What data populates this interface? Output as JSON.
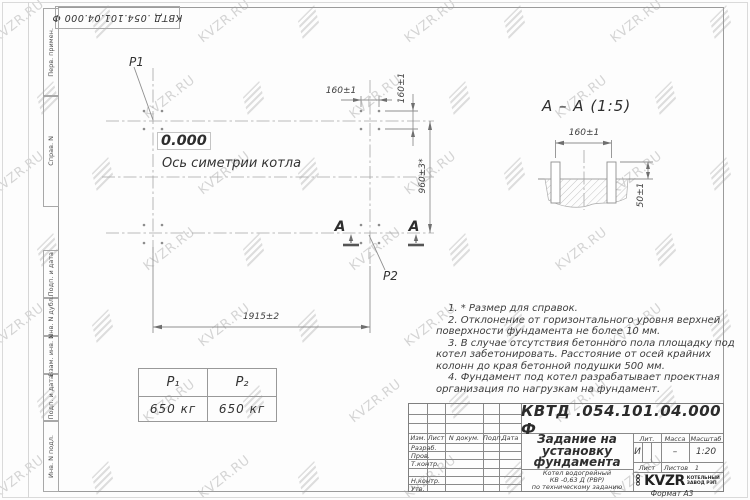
{
  "watermark": {
    "text": "KVZR.RU",
    "icon": "kvzr-logo-icon"
  },
  "frame": {
    "top_designation": "КВТД .054.101.04.000  Ф",
    "left_labels": [
      "Перв. примен.",
      "Справ. N",
      "Подп. и дата",
      "Инв. N дубл.",
      "Взам. инв. N",
      "Подп. и дата",
      "Инв. N подл."
    ]
  },
  "plan": {
    "p1_label": "P1",
    "p2_label": "P2",
    "level_label": "0.000",
    "axis_label": "Ось симетрии котла",
    "dim_width": "1915±2",
    "dim_bolt_spacing_h": "160±1",
    "dim_bolt_spacing_v": "160±1",
    "dim_height": "960±3*",
    "section_letter": "А"
  },
  "section": {
    "title": "А – А (1:5)",
    "dim_spacing": "160±1",
    "dim_protrusion": "50±1"
  },
  "notes": [
    "1. * Размер для справок.",
    "2. Отклонение от горизонтального уровня верхней поверхности фундамента не более 10 мм.",
    "3. В случае отсутствия бетонного пола площадку под котел забетонировать. Расстояние от осей крайних колонн до края бетонной подушки 500 мм.",
    "4. Фундамент под котел разрабатывает проектная организация по нагрузкам на фундамент."
  ],
  "load_table": {
    "headers": [
      "Р₁",
      "Р₂"
    ],
    "values": [
      "650 кг",
      "650 кг"
    ]
  },
  "title_block": {
    "designation": "КВТД .054.101.04.000  Ф",
    "doc_title": "Задание на установку фундамента",
    "subtitle_lines": [
      "Котел водогрейный",
      "КВ -0,63 Д  (РВР)",
      "по техническому заданию"
    ],
    "col_izm": "Изм.",
    "col_list": "Лист",
    "col_ndoc": "N докум.",
    "col_podp": "Подп.",
    "col_data": "Дата",
    "rows": [
      "Разраб.",
      "Пров.",
      "Т.контр.",
      "Н.контр.",
      "Утв."
    ],
    "lit_header": "Лит.",
    "lit_value": "И",
    "massa_header": "Масса",
    "massa_value": "–",
    "scale_header": "Масштаб",
    "scale_value": "1:20",
    "sheet_header": "Лист",
    "sheets_header": "Листов",
    "sheets_value": "1",
    "logo_ooo": "ООО",
    "logo_text": "KVZR",
    "logo_caption": [
      "КОТЕЛЬНЫЙ",
      "ЗАВОД РЭП"
    ],
    "format": "Формат А3"
  }
}
